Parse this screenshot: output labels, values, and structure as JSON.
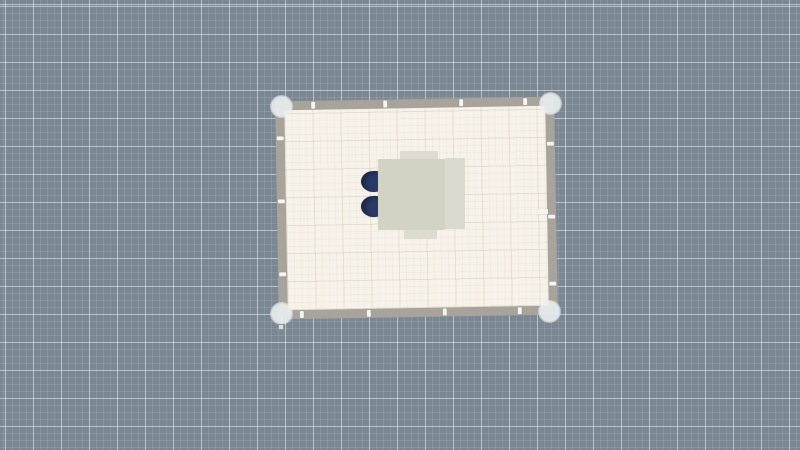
{
  "app": {
    "name": "floor-plan-editor",
    "view": "2d-plan-canvas",
    "description": "Empty 2D floor-plan canvas showing one rectangular room with four corner handles, wall edit ticks, and a dining table with two navy chairs"
  },
  "colors": {
    "canvas_bg": "#7b8894",
    "grid_minor": "rgba(255,255,255,0.10)",
    "grid_major": "rgba(255,255,255,0.42)",
    "floor": "#f8f3ea",
    "floor_grid_minor": "rgba(185,170,140,0.10)",
    "floor_grid_major": "rgba(185,170,140,0.20)",
    "wall": "#a8a49b",
    "tick": "#f4f5f6",
    "handle": "rgba(235,238,240,0.90)",
    "handle_soft": "rgba(235,238,240,0.40)",
    "marker_line": "rgba(240,242,244,0.70)",
    "marker_fill": "rgba(235,238,240,0.85)",
    "marker_border": "rgba(120,130,140,0.80)",
    "table": "#d2d2c5",
    "table_right": "#dadace",
    "chair_tucked": "#dcdcd1",
    "chair_navy_dark": "#1b2540",
    "chair_navy": "#2a3a64"
  },
  "room": {
    "style": {
      "left": "277px",
      "top": "99px",
      "width": "279px",
      "height": "218px",
      "transform": "rotate(-1deg)"
    },
    "ticks": [
      {
        "wall": "top",
        "style": {
          "left": "27px"
        }
      },
      {
        "wall": "top",
        "style": {
          "left": "99px"
        }
      },
      {
        "wall": "top",
        "style": {
          "left": "175px"
        }
      },
      {
        "wall": "top",
        "style": {
          "left": "239px"
        }
      },
      {
        "wall": "bottom",
        "style": {
          "left": "12px"
        }
      },
      {
        "wall": "bottom",
        "style": {
          "left": "79px"
        }
      },
      {
        "wall": "bottom",
        "style": {
          "left": "155px"
        }
      },
      {
        "wall": "bottom",
        "style": {
          "left": "230px"
        }
      },
      {
        "wall": "left",
        "style": {
          "top": "26px"
        }
      },
      {
        "wall": "left",
        "style": {
          "top": "89px"
        }
      },
      {
        "wall": "left",
        "style": {
          "top": "162px"
        }
      },
      {
        "wall": "right",
        "style": {
          "top": "36px"
        }
      },
      {
        "wall": "right",
        "style": {
          "top": "109px"
        }
      },
      {
        "wall": "right",
        "style": {
          "top": "176px"
        }
      }
    ]
  },
  "handles": {
    "top_left": {
      "left": "270px",
      "top": "95px"
    },
    "top_right": {
      "left": "539px",
      "top": "92px"
    },
    "bottom_left": {
      "left": "270px",
      "top": "302px"
    },
    "bottom_right": {
      "left": "538px",
      "top": "300px"
    }
  },
  "sub_marker": {
    "line": {
      "left": "281px",
      "top": "316px",
      "width": "1px",
      "height": "9px"
    },
    "square": {
      "left": "278px",
      "top": "324px",
      "width": "6px",
      "height": "6px"
    }
  },
  "wall_marker_right": {
    "left": "538px",
    "top": "209px",
    "width": "10px",
    "height": "5px"
  },
  "furniture": {
    "table_main": {
      "left": "378px",
      "top": "159px",
      "width": "67px",
      "height": "71px"
    },
    "table_right_strip": {
      "left": "445px",
      "top": "158px",
      "width": "20px",
      "height": "71px"
    },
    "chair_tucked_top": {
      "left": "400px",
      "top": "151px",
      "width": "38px",
      "height": "10px"
    },
    "chair_tucked_bottom": {
      "left": "404px",
      "top": "230px",
      "width": "33px",
      "height": "9px"
    },
    "chair_navy_1": {
      "left": "361px",
      "top": "171px",
      "width": "25px",
      "height": "21px"
    },
    "chair_navy_2": {
      "left": "361px",
      "top": "196px",
      "width": "25px",
      "height": "21px"
    }
  }
}
